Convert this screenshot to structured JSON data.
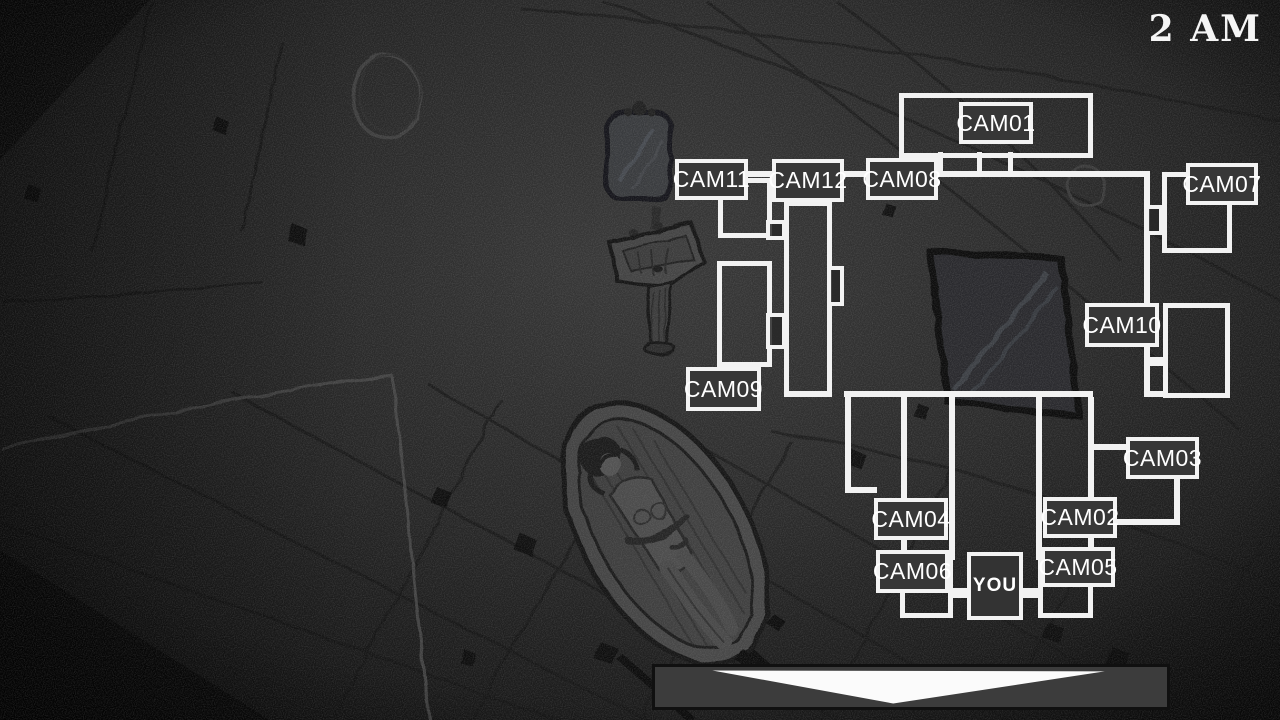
{
  "hud": {
    "time": "2 AM"
  },
  "map": {
    "line_color": "#f2f2f2",
    "box_fill": "#373737",
    "cameras": [
      {
        "id": "cam01",
        "label": "CAM01",
        "x": 959,
        "y": 102,
        "w": 74,
        "h": 42
      },
      {
        "id": "cam11",
        "label": "CAM11",
        "x": 675,
        "y": 159,
        "w": 73,
        "h": 41
      },
      {
        "id": "cam12",
        "label": "CAM12",
        "x": 772,
        "y": 159,
        "w": 72,
        "h": 43
      },
      {
        "id": "cam08",
        "label": "CAM08",
        "x": 866,
        "y": 158,
        "w": 72,
        "h": 42
      },
      {
        "id": "cam07",
        "label": "CAM07",
        "x": 1186,
        "y": 163,
        "w": 72,
        "h": 42
      },
      {
        "id": "cam10",
        "label": "CAM10",
        "x": 1085,
        "y": 303,
        "w": 74,
        "h": 44
      },
      {
        "id": "cam09",
        "label": "CAM09",
        "x": 686,
        "y": 367,
        "w": 75,
        "h": 44
      },
      {
        "id": "cam03",
        "label": "CAM03",
        "x": 1126,
        "y": 437,
        "w": 73,
        "h": 42
      },
      {
        "id": "cam02",
        "label": "CAM02",
        "x": 1043,
        "y": 497,
        "w": 74,
        "h": 41
      },
      {
        "id": "cam04",
        "label": "CAM04",
        "x": 874,
        "y": 498,
        "w": 74,
        "h": 42
      },
      {
        "id": "cam05",
        "label": "CAM05",
        "x": 1041,
        "y": 547,
        "w": 74,
        "h": 40
      },
      {
        "id": "cam06",
        "label": "CAM06",
        "x": 876,
        "y": 550,
        "w": 73,
        "h": 43
      }
    ],
    "you": {
      "label": "YOU",
      "x": 967,
      "y": 552,
      "w": 56,
      "h": 68
    },
    "rooms": [
      {
        "x": 899,
        "y": 93,
        "w": 194,
        "h": 65
      },
      {
        "x": 1162,
        "y": 172,
        "w": 70,
        "h": 81
      },
      {
        "x": 1163,
        "y": 303,
        "w": 67,
        "h": 95
      },
      {
        "x": 718,
        "y": 178,
        "w": 54,
        "h": 60
      },
      {
        "x": 717,
        "y": 261,
        "w": 55,
        "h": 106
      },
      {
        "x": 784,
        "y": 201,
        "w": 48,
        "h": 196
      },
      {
        "x": 900,
        "y": 556,
        "w": 53,
        "h": 62
      },
      {
        "x": 1038,
        "y": 556,
        "w": 55,
        "h": 62
      }
    ],
    "walls": [
      {
        "x": 747,
        "y": 171,
        "w": 403,
        "h": 6
      },
      {
        "x": 1144,
        "y": 171,
        "w": 6,
        "h": 226
      },
      {
        "x": 1144,
        "y": 391,
        "w": 19,
        "h": 6
      },
      {
        "x": 784,
        "y": 391,
        "w": 45,
        "h": 6
      },
      {
        "x": 844,
        "y": 391,
        "w": 249,
        "h": 6
      },
      {
        "x": 845,
        "y": 397,
        "w": 6,
        "h": 93
      },
      {
        "x": 845,
        "y": 487,
        "w": 32,
        "h": 6
      },
      {
        "x": 901,
        "y": 397,
        "w": 6,
        "h": 163
      },
      {
        "x": 949,
        "y": 397,
        "w": 6,
        "h": 163
      },
      {
        "x": 1036,
        "y": 397,
        "w": 6,
        "h": 163
      },
      {
        "x": 1088,
        "y": 397,
        "w": 6,
        "h": 163
      },
      {
        "x": 938,
        "y": 152,
        "w": 5,
        "h": 24
      },
      {
        "x": 977,
        "y": 152,
        "w": 5,
        "h": 24
      },
      {
        "x": 1008,
        "y": 152,
        "w": 5,
        "h": 24
      },
      {
        "x": 1146,
        "y": 357,
        "w": 18,
        "h": 9
      },
      {
        "x": 1094,
        "y": 444,
        "w": 33,
        "h": 6
      },
      {
        "x": 1174,
        "y": 479,
        "w": 6,
        "h": 46
      },
      {
        "x": 1117,
        "y": 519,
        "w": 63,
        "h": 6
      },
      {
        "x": 949,
        "y": 588,
        "w": 19,
        "h": 10
      },
      {
        "x": 1022,
        "y": 588,
        "w": 17,
        "h": 10
      }
    ],
    "doors": [
      {
        "x": 1145,
        "y": 205,
        "w": 18,
        "h": 30
      },
      {
        "x": 766,
        "y": 220,
        "w": 20,
        "h": 20
      },
      {
        "x": 766,
        "y": 313,
        "w": 20,
        "h": 36
      },
      {
        "x": 827,
        "y": 266,
        "w": 17,
        "h": 40
      }
    ]
  },
  "banner": {
    "x": 652,
    "y": 664,
    "w": 518,
    "h": 46,
    "fill": "#3c3c3c",
    "arrow_color": "#fbfbfb",
    "arrow_points": "58,4 455,5 241,42"
  }
}
